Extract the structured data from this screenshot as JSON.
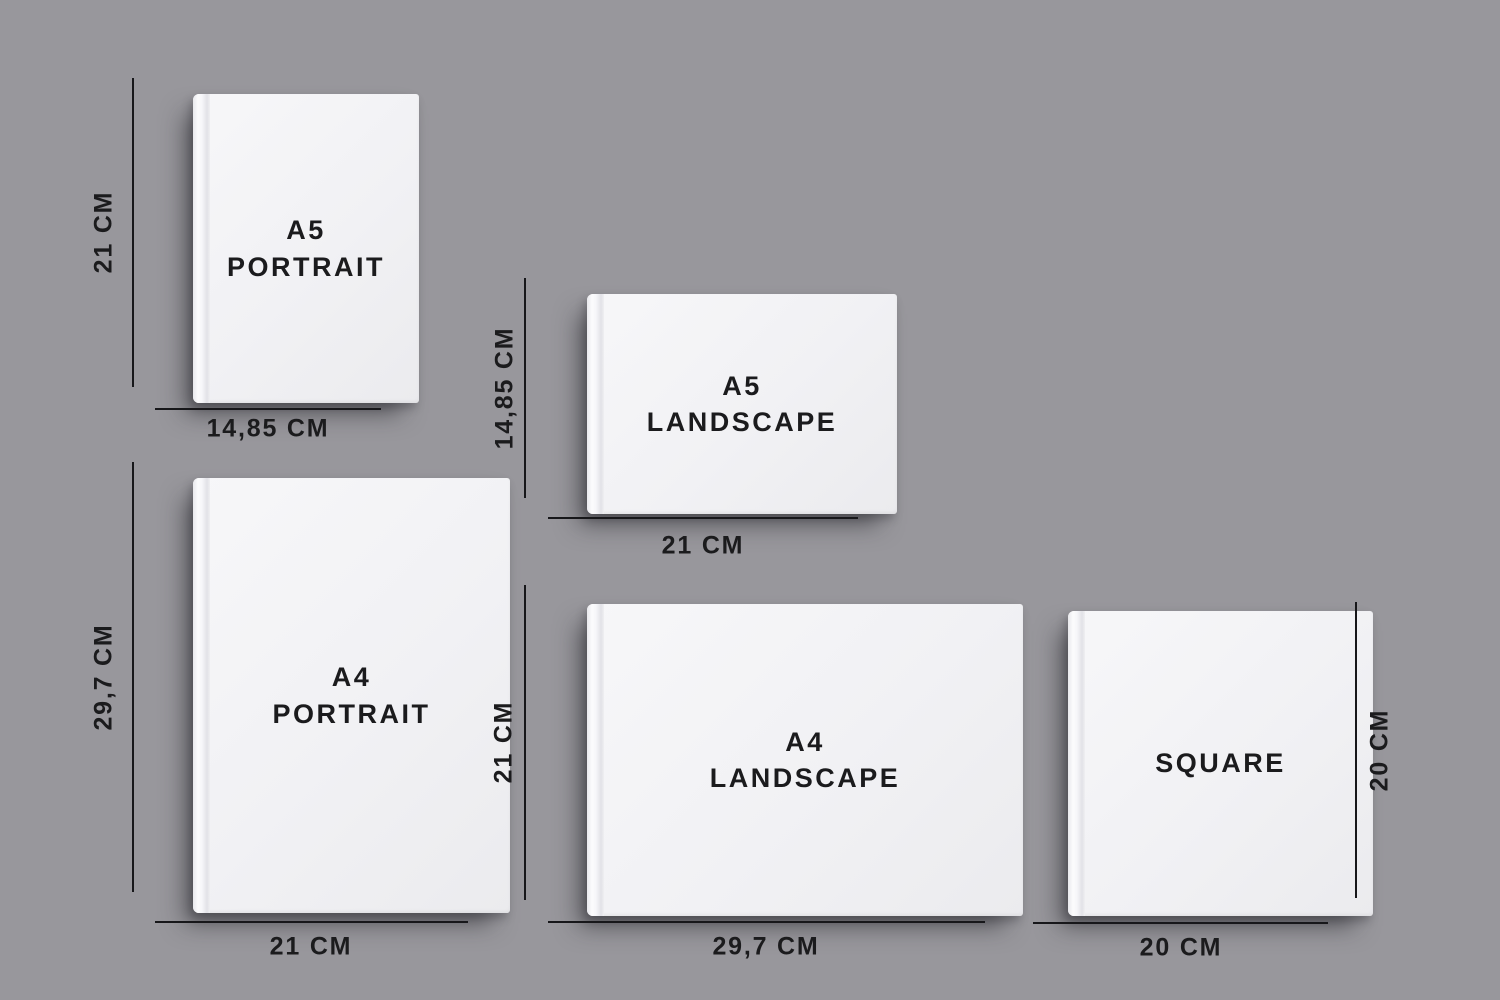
{
  "canvas": {
    "background_color": "#98979c",
    "line_color": "#17171a",
    "text_color": "#1b1b1d",
    "book_color": "#f1f1f4"
  },
  "books": {
    "a5_portrait": {
      "title_lines": [
        "A5",
        "PORTRAIT"
      ],
      "height_label": "21 CM",
      "width_label": "14,85 CM"
    },
    "a5_landscape": {
      "title_lines": [
        "A5",
        "LANDSCAPE"
      ],
      "height_label": "14,85 CM",
      "width_label": "21 CM"
    },
    "a4_portrait": {
      "title_lines": [
        "A4",
        "PORTRAIT"
      ],
      "height_label": "29,7 CM",
      "width_label": "21 CM"
    },
    "a4_landscape": {
      "title_lines": [
        "A4",
        "LANDSCAPE"
      ],
      "height_label": "21 CM",
      "width_label": "29,7 CM"
    },
    "square": {
      "title_lines": [
        "SQUARE"
      ],
      "height_label": "20 CM",
      "width_label": "20 CM"
    }
  }
}
